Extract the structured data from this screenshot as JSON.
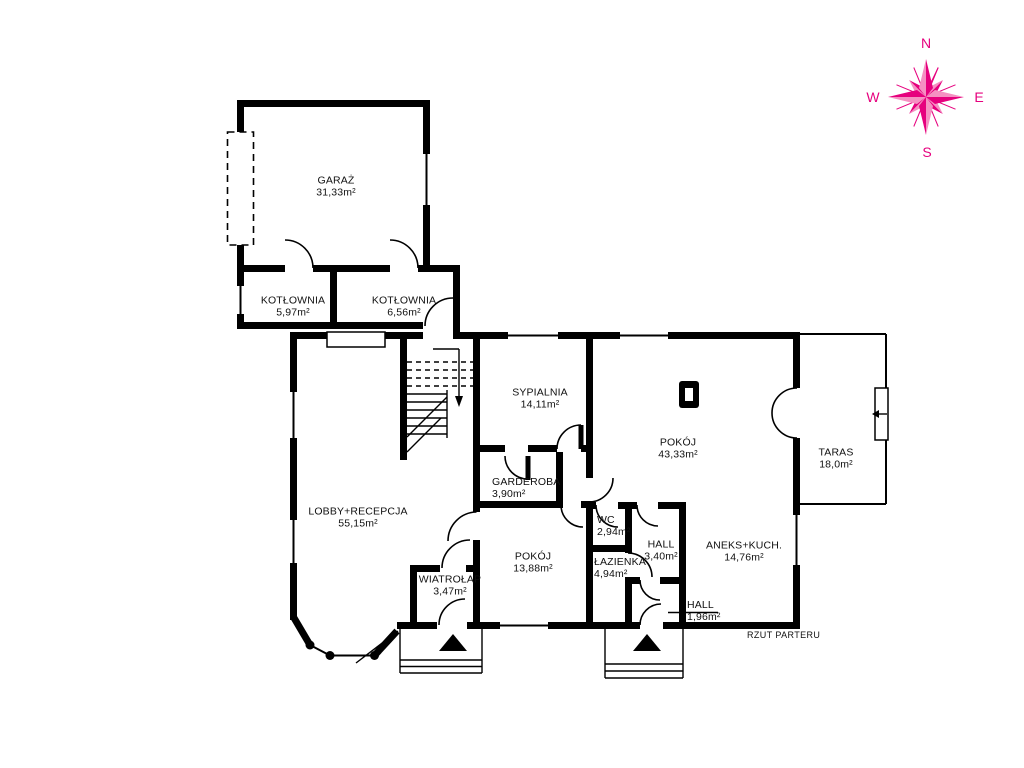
{
  "plan": {
    "title": "RZUT PARTERU",
    "rooms": [
      {
        "name": "GARAŻ",
        "area": "31,33m²"
      },
      {
        "name": "KOTŁOWNIA",
        "area": "5,97m²"
      },
      {
        "name": "KOTŁOWNIA",
        "area": "6,56m²"
      },
      {
        "name": "SYPIALNIA",
        "area": "14,11m²"
      },
      {
        "name": "POKÓJ",
        "area": "43,33m²"
      },
      {
        "name": "TARAS",
        "area": "18,0m²"
      },
      {
        "name": "LOBBY+RECEPCJA",
        "area": "55,15m²"
      },
      {
        "name": "GARDEROBA",
        "area": "3,90m²"
      },
      {
        "name": "WC",
        "area": "2,94m²"
      },
      {
        "name": "POKÓJ",
        "area": "13,88m²"
      },
      {
        "name": "ŁAZIENKA",
        "area": "4,94m²"
      },
      {
        "name": "HALL",
        "area": "3,40m²"
      },
      {
        "name": "ANEKS+KUCH.",
        "area": "14,76m²"
      },
      {
        "name": "WIATROŁAP",
        "area": "3,47m²"
      },
      {
        "name": "HALL",
        "area": "1,96m²"
      }
    ],
    "compass": {
      "n": "N",
      "e": "E",
      "s": "S",
      "w": "W"
    },
    "colors": {
      "wall": "#000000",
      "compass": "#e6007e",
      "compass_light": "#f590c2"
    }
  }
}
